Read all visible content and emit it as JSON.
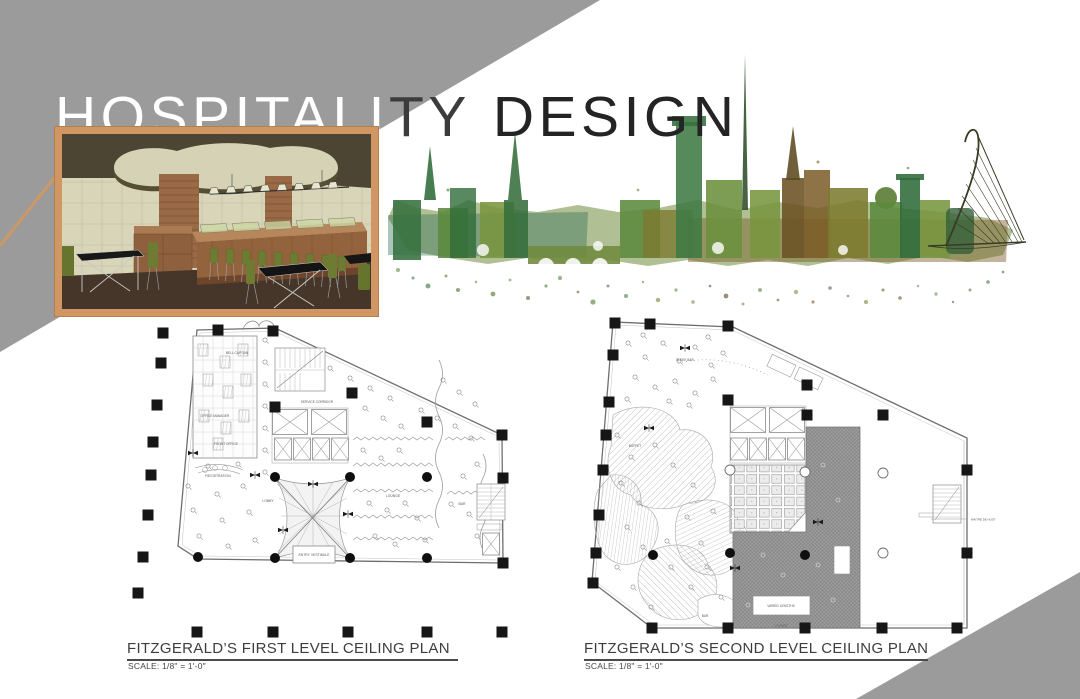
{
  "header": {
    "title_light": "HOSPITALI",
    "title_mid": "TY",
    "title_rest": "DESIGN"
  },
  "plans": [
    {
      "title": "FITZGERALD’S FIRST LEVEL CEILING PLAN",
      "scale": "SCALE: 1/8\" =  1'-0\"",
      "labels": {
        "bell_captain": "BELL CAPTAIN",
        "office_manager": "OFFICE MANAGER",
        "front_office": "FRONT OFFICE",
        "service_corridor": "SERVICE CORRIDOR",
        "registration": "REGISTRATION",
        "lobby": "LOBBY",
        "lounge": "LOUNGE",
        "entry_vestibule": "ENTRY VESTIBULE",
        "bar": "BAR"
      }
    },
    {
      "title": "FITZGERALD’S SECOND LEVEL CEILING PLAN",
      "scale": "SCALE: 1/8\" =  1'-0\"",
      "labels": {
        "sleek_bar": "SLEEK BAR",
        "buffet": "BUFFET",
        "maitre_de_host": "MAITRE DE HOST",
        "varied_lengths": "VARIED LENGTHS",
        "lounge": "LOUNGE",
        "bar": "BAR"
      }
    }
  ],
  "colors": {
    "banner_gray": "#9b9b9b",
    "accent_tan": "#d09764",
    "title_mid_gray": "#3c3c3c",
    "title_black": "#242424",
    "skyline_green": "#35713f",
    "skyline_olive": "#7d7b2f",
    "skyline_brown": "#7a5a26"
  }
}
